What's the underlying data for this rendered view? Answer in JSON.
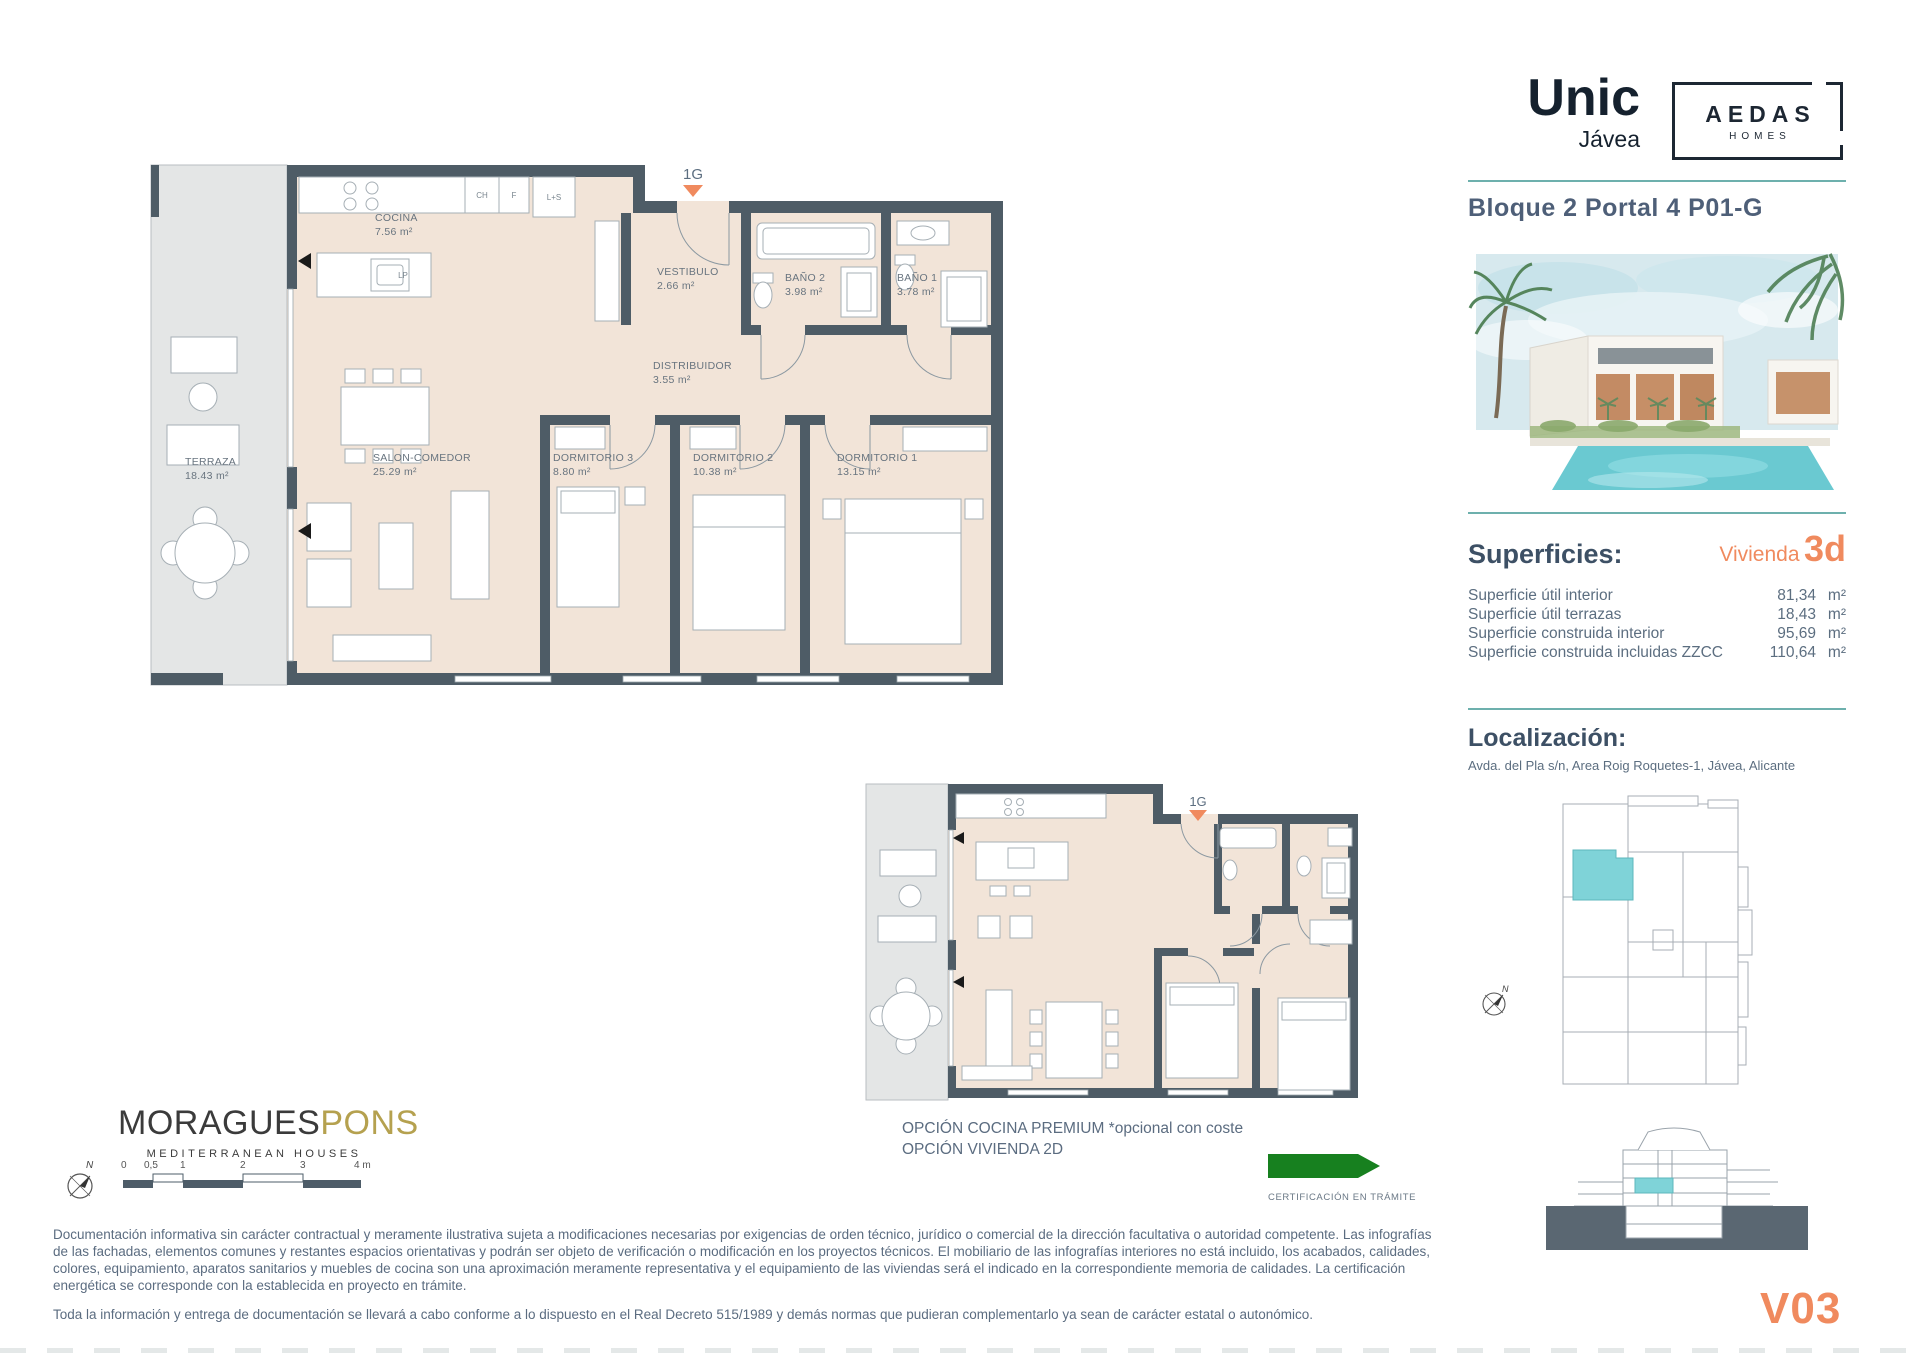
{
  "header": {
    "brand": "Unic",
    "brand_sub": "Jávea",
    "partner_line1": "AEDAS",
    "partner_line2": "HOMES",
    "unit_title": "Bloque 2 Portal 4 P01-G"
  },
  "superficies": {
    "title": "Superficies:",
    "vivienda_label": "Vivienda",
    "vivienda_value": "3d",
    "rows": [
      {
        "label": "Superficie útil interior",
        "value": "81,34",
        "unit": "m²"
      },
      {
        "label": "Superficie útil terrazas",
        "value": "18,43",
        "unit": "m²"
      },
      {
        "label": "Superficie construida interior",
        "value": "95,69",
        "unit": "m²"
      },
      {
        "label": "Superficie construida incluidas ZZCC",
        "value": "110,64",
        "unit": "m²"
      }
    ]
  },
  "localizacion": {
    "title": "Localización:",
    "address": "Avda. del Pla s/n, Area Roig Roquetes-1, Jávea, Alicante"
  },
  "main_plan": {
    "marker": "1G",
    "rooms": [
      {
        "name": "COCINA",
        "area": "7.56 m²"
      },
      {
        "name": "VESTIBULO",
        "area": "2.66 m²"
      },
      {
        "name": "BAÑO 2",
        "area": "3.98 m²"
      },
      {
        "name": "BAÑO 1",
        "area": "3.78 m²"
      },
      {
        "name": "DISTRIBUIDOR",
        "area": "3.55 m²"
      },
      {
        "name": "SALON-COMEDOR",
        "area": "25.29 m²"
      },
      {
        "name": "DORMITORIO 3",
        "area": "8.80 m²"
      },
      {
        "name": "DORMITORIO 2",
        "area": "10.38 m²"
      },
      {
        "name": "DORMITORIO 1",
        "area": "13.15 m²"
      },
      {
        "name": "TERRAZA",
        "area": "18.43 m²"
      }
    ],
    "fixtures": {
      "ch": "CH",
      "f": "F",
      "ls": "L+S",
      "lp": "LP"
    }
  },
  "option_plan": {
    "marker": "1G",
    "caption_line1": "OPCIÓN COCINA PREMIUM *opcional con coste",
    "caption_line2": "OPCIÓN VIVIENDA 2D"
  },
  "certification": {
    "label": "CERTIFICACIÓN EN TRÁMITE"
  },
  "architect": {
    "name_primary": "MORAGUES",
    "name_secondary": "PONS",
    "tagline": "MEDITERRANEAN HOUSES"
  },
  "scale_bar": {
    "labels": [
      "0",
      "0,5",
      "1",
      "2",
      "3",
      "4 m"
    ]
  },
  "compass": {
    "label": "N"
  },
  "disclaimer": {
    "paragraph1": "Documentación informativa sin carácter contractual y meramente ilustrativa sujeta a modificaciones necesarias por exigencias de orden técnico, jurídico o comercial de la dirección facultativa o autoridad competente. Las infografías de las fachadas, elementos comunes y restantes espacios orientativas y podrán ser objeto de verificación o modificación en los proyectos técnicos. El mobiliario de las infografías interiores no está incluido, los acabados, calidades, colores, equipamiento, aparatos sanitarios y muebles de cocina son una aproximación meramente representativa y el equipamiento de las viviendas será el indicado en la correspondiente memoria de calidades. La certificación energética se corresponde con la establecida en proyecto en trámite.",
    "paragraph2": "Toda la información y entrega de documentación se llevará a cabo conforme a lo dispuesto en el Real Decreto 515/1989 y demás normas que pudieran complementarlo ya sean de carácter estatal o autonómico."
  },
  "version": "V03",
  "colors": {
    "wall": "#4e5c66",
    "floor": "#f2e4d8",
    "terrace": "#e4e6e6",
    "teal_rule": "#6db0ad",
    "teal_unit": "#7fd3d8",
    "accent_orange": "#f08a5e",
    "cert_green": "#17801f",
    "brand_navy": "#15212e",
    "gold": "#b5a14f"
  }
}
